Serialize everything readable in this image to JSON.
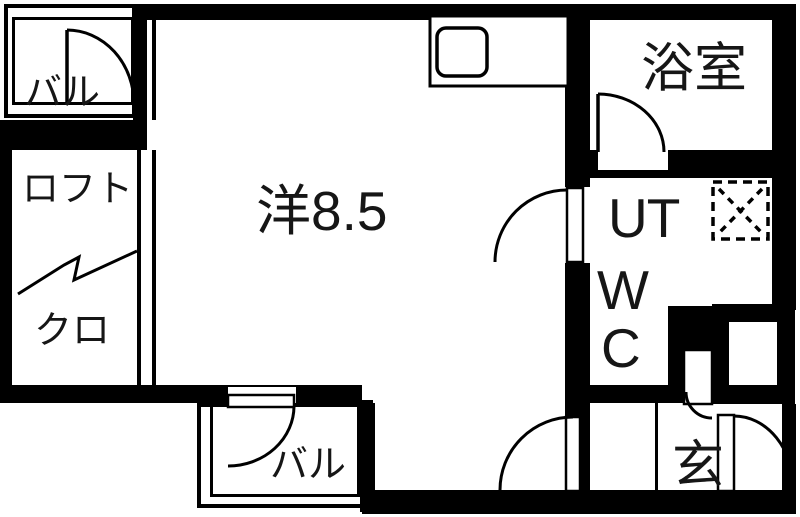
{
  "plan": {
    "type": "apartment-floorplan",
    "rooms": {
      "balcony_top": "バル",
      "loft": "ロフト",
      "closet": "クロ",
      "main": "洋8.5",
      "bath": "浴室",
      "utility": "UT",
      "wc_w": "W",
      "wc_c": "C",
      "entrance": "玄",
      "balcony_bottom": "バル"
    },
    "symbols": {
      "washing_machine": "washing-machine-place-symbol",
      "kitchen_sink": "kitchen-sink-symbol",
      "loft_break_line": "zigzag-break-line",
      "doors": "quarter-circle-door-swings"
    },
    "colors": {
      "line": "#000000",
      "floor": "#ffffff"
    }
  }
}
